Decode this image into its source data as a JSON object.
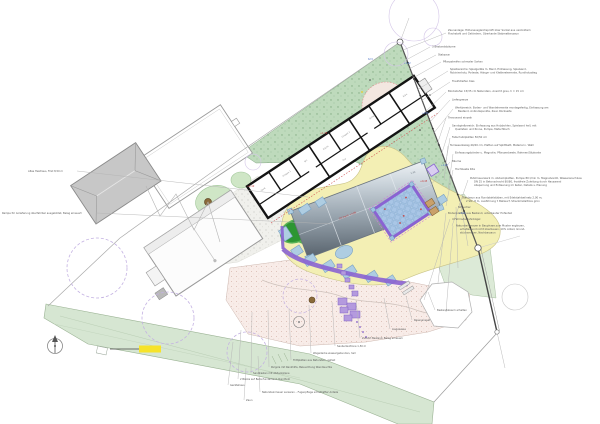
{
  "drawing": {
    "type": "landscape-site-plan",
    "colors": {
      "sand": "#f3efb4",
      "mound_dark": "#2d9632",
      "mound_rim": "#57b257",
      "grass_north": "#bedabc",
      "grass_wedge": "#d6e6d2",
      "lawn": "#dcead7",
      "terrace_border": "#8a63d2",
      "terrace_tile": "#a9c6e6",
      "pink_gravel": "#f8ece8",
      "roof_dark": "#57626c",
      "roof_light": "#eef2f5",
      "play_blue": "#aecde2",
      "stepping_stone": "#b49ade",
      "highlight_yellow": "#f6e32a",
      "tree_trunk": "#8a6a3a"
    }
  },
  "annotations": {
    "right": [
      "Zaunanlage: Höhenausgleichsprofil über Sockel aus verzinktem",
      "Flachstahl und Geländern, Oberkante Stabmattenzaun",
      "3 Bestandsbäume",
      "Stabzaun",
      "Pflanzstreifen schmaler Sorten",
      "Spielbereiche: Spielgeräte m. Band, Einfassung, Spielsand,",
      "Robinienholz, Podeste, Hänge- und Kletterelemente, Rundholzstieg",
      "Traufstreifen Kies",
      "Blockstufen 15/35 cm Naturstein, Ansicht grau, h = 15 cm",
      "Liefergrenze",
      "Werkbereich: Boden- und Wandelemente montagefertig, Einfassung am",
      "Bestand, Anbindepunkte, Zaun Rückseite",
      "Trennwand einzeln",
      "Sandspielbereich: Einfassung aus Holzbohlen, Spielsand hell, mit",
      "Quellstein und Rinne, Pumpe, Matschtisch",
      "Fallschutzplatten 50/50 cm",
      "Terrassenbelag 40/40 cm, Platten auf Splittbett, Material n. Wahl",
      "Einfassungsbänder u. Magnolie, Pflanzenbeete, Rahmen/Sitzkante",
      "Bäume",
      "Hochbeete Kita",
      "Putzmauerwerk m. Abdeckplatten, Pumpe 80 l/min m. Magnetventil, Wasseranschluss",
      "DN 25 in Betonschacht 80/80, frostfreie Zuleitung durch Hauswand",
      "Absperrung und Entleerung im Keller, Details s. Planung",
      "Stahlzaun aus Rundstahlstäben, mit Edelstahlseilnetz 2,00 m,",
      "2 Stk. 8 m, Ausführung f. Ballwurf, Streckmetalltore grün",
      "Sträucher",
      "Bodenplatten aus Bestand, unterbauter Hofanteil",
      "4 Fahrradanlehnbügel",
      "Natursteinmauer in Bauphase zum Muster ergänzen,",
      "erhalten und nicht überbauen, 10% Anteil, Grund-",
      "stücksmauer, Nachbarzaun"
    ],
    "bottom": [
      "Bestandsbaum erhalten",
      "Rasenansaat",
      "Liegewiese",
      "Zufahrt Bestand, Belag erneuern",
      "Sauberlaufzone 1,50 m",
      "Wegedecke wassergebunden, hell",
      "Trittplatten aus Naturstein, gefast",
      "Pergola mit Rankhilfe, Beleuchtung Wandleuchte",
      "Sandkasten mit Abdeckplane",
      "2 Bänke auf Betonfundament, Rundholz",
      "Gerätehaus",
      "Natursteinmauer sanieren – Fugenpflege schadhafter Anteile",
      "Zaun"
    ],
    "left": [
      "Altes Heizhaus, First 8,50 m",
      "Rampe für Anlieferung überfahrbar ausgebildet, Belag erneuert"
    ]
  },
  "plan": {
    "rooms": [
      "Gard.",
      "Gruppe 1",
      "WC",
      "Küche",
      "Gruppe 2",
      "Schlafr.",
      "Büro",
      "Flur"
    ],
    "levels_blue": [
      "62,5",
      "+0,62",
      "+0,55",
      "+0,48",
      "+0,40"
    ],
    "levels_red": [
      "+1,10",
      "+1,35",
      "+0,45"
    ],
    "canopy": {
      "label": "OK Dach +3,85",
      "dim_a": "5,80",
      "dim_b": "2,60"
    }
  }
}
